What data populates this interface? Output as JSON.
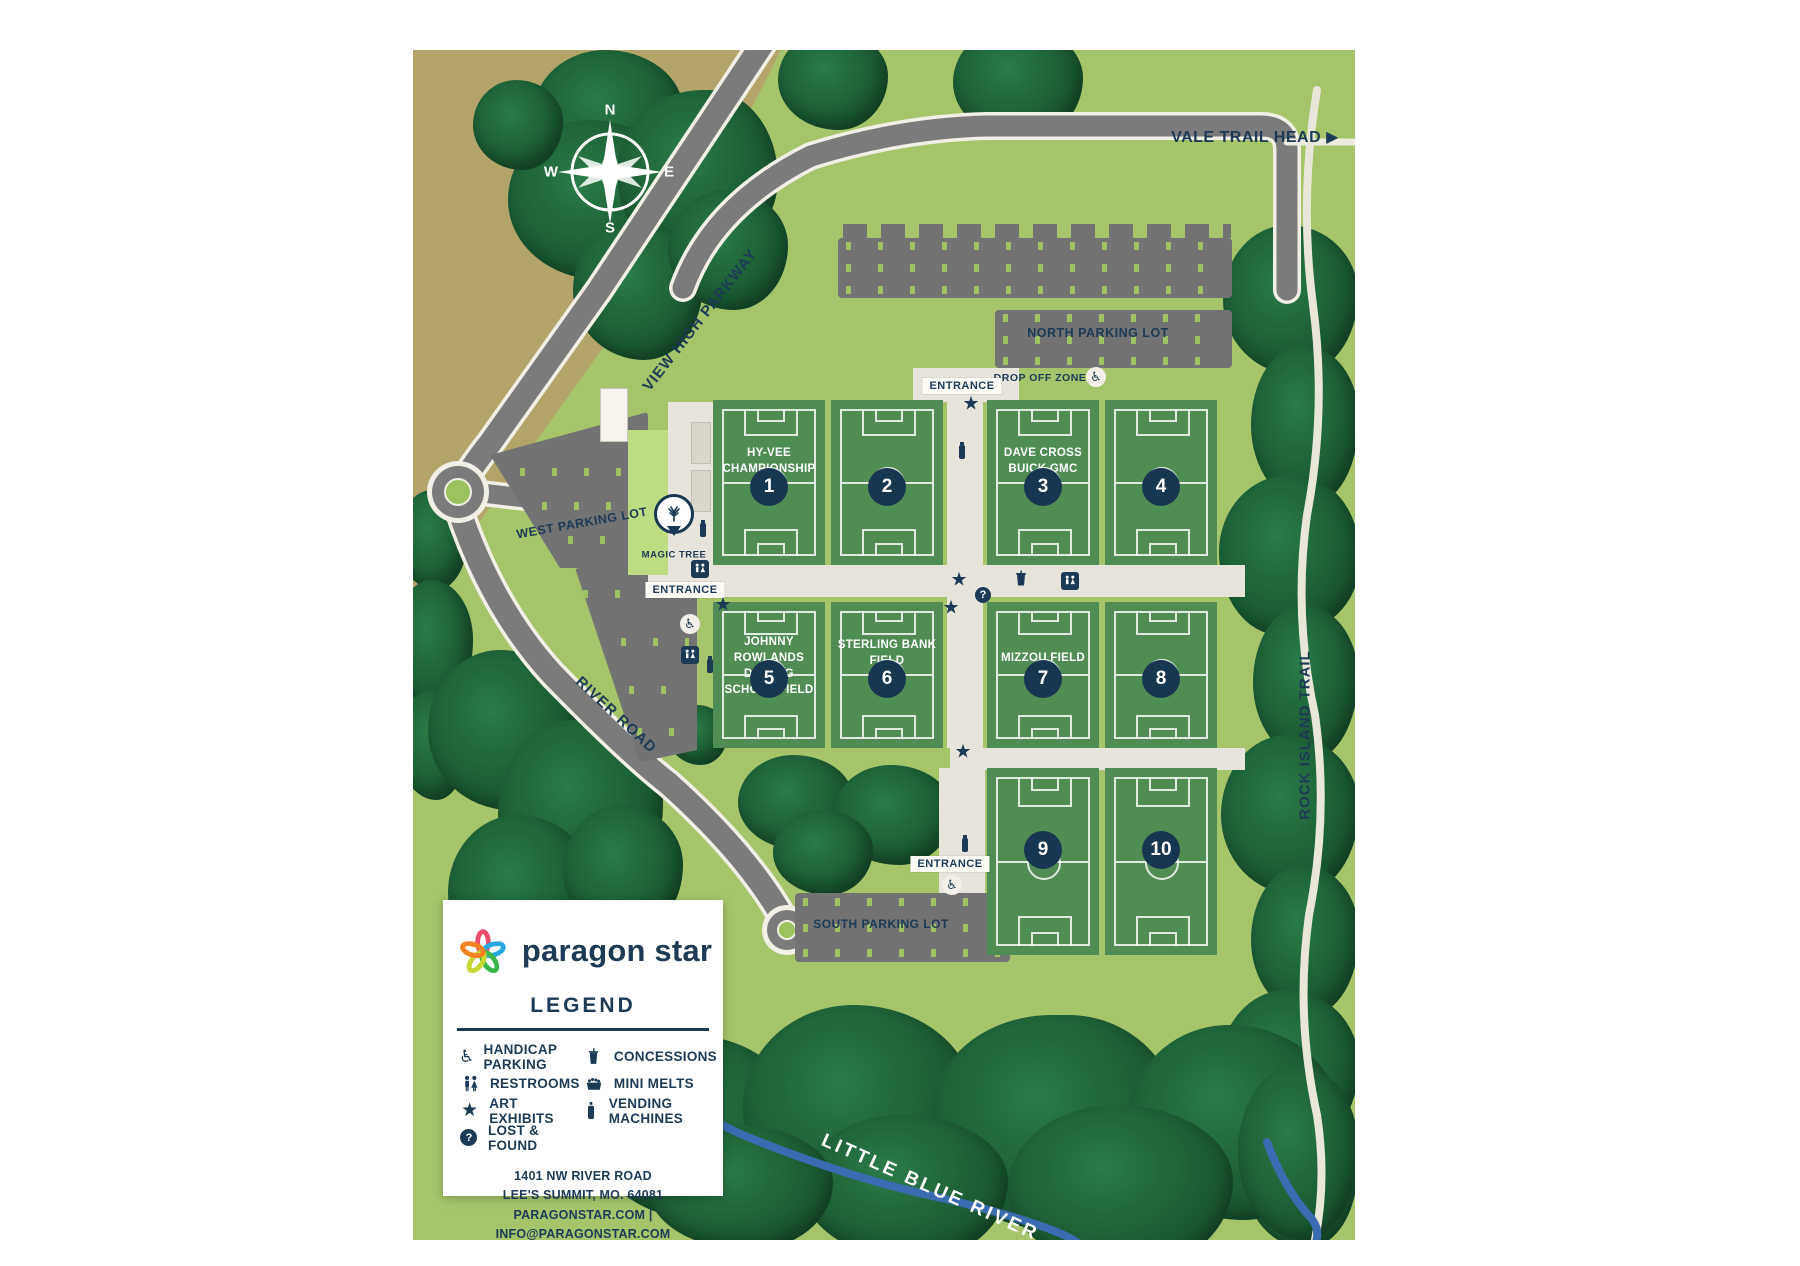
{
  "map": {
    "compass": {
      "n": "N",
      "e": "E",
      "s": "S",
      "w": "W"
    },
    "trail_head_label": "VALE TRAIL HEAD",
    "roads": {
      "view_high_parkway": "VIEW HIGH PARKWAY",
      "river_road": "RIVER ROAD",
      "rock_island_trail": "ROCK ISLAND TRAIL",
      "little_blue_river": "LITTLE BLUE RIVER"
    },
    "parking": {
      "north": "NORTH PARKING LOT",
      "west": "WEST PARKING LOT",
      "south": "SOUTH PARKING LOT",
      "drop_off": "DROP OFF ZONE"
    },
    "entrance_label": "ENTRANCE",
    "magic_tree_label": "MAGIC TREE",
    "fields": [
      {
        "num": "1",
        "name": "HY-VEE CHAMPIONSHIP FIELD"
      },
      {
        "num": "2",
        "name": ""
      },
      {
        "num": "3",
        "name": "DAVE CROSS BUICK GMC FIELD"
      },
      {
        "num": "4",
        "name": ""
      },
      {
        "num": "5",
        "name": "JOHNNY ROWLANDS DRIVING SCHOOL FIELD"
      },
      {
        "num": "6",
        "name": "STERLING BANK FIELD"
      },
      {
        "num": "7",
        "name": "MIZZOU FIELD"
      },
      {
        "num": "8",
        "name": ""
      },
      {
        "num": "9",
        "name": ""
      },
      {
        "num": "10",
        "name": ""
      }
    ]
  },
  "legend": {
    "brand": "paragon star",
    "title": "LEGEND",
    "col1": [
      {
        "icon": "handicap-parking-icon",
        "label": "HANDICAP PARKING"
      },
      {
        "icon": "restrooms-icon",
        "label": "RESTROOMS"
      },
      {
        "icon": "art-exhibits-icon",
        "label": "ART EXHIBITS"
      },
      {
        "icon": "lost-and-found-icon",
        "label": "LOST & FOUND"
      }
    ],
    "col2": [
      {
        "icon": "concessions-icon",
        "label": "CONCESSIONS"
      },
      {
        "icon": "mini-melts-icon",
        "label": "MINI MELTS"
      },
      {
        "icon": "vending-machines-icon",
        "label": "VENDING MACHINES"
      }
    ],
    "address_line1": "1401 NW RIVER ROAD",
    "address_line2": "LEE'S SUMMIT, MO. 64081",
    "address_line3": "PARAGONSTAR.COM | INFO@PARAGONSTAR.COM"
  },
  "colors": {
    "navy": "#1c3a55",
    "field_green": "#4f8d55",
    "grass_green": "#a6c56b",
    "tan": "#b3a56a",
    "forest": "#1b5c34",
    "road_gray": "#7b7b7b",
    "walkway": "#e7e4dc",
    "river_blue": "#3a6cb2"
  }
}
